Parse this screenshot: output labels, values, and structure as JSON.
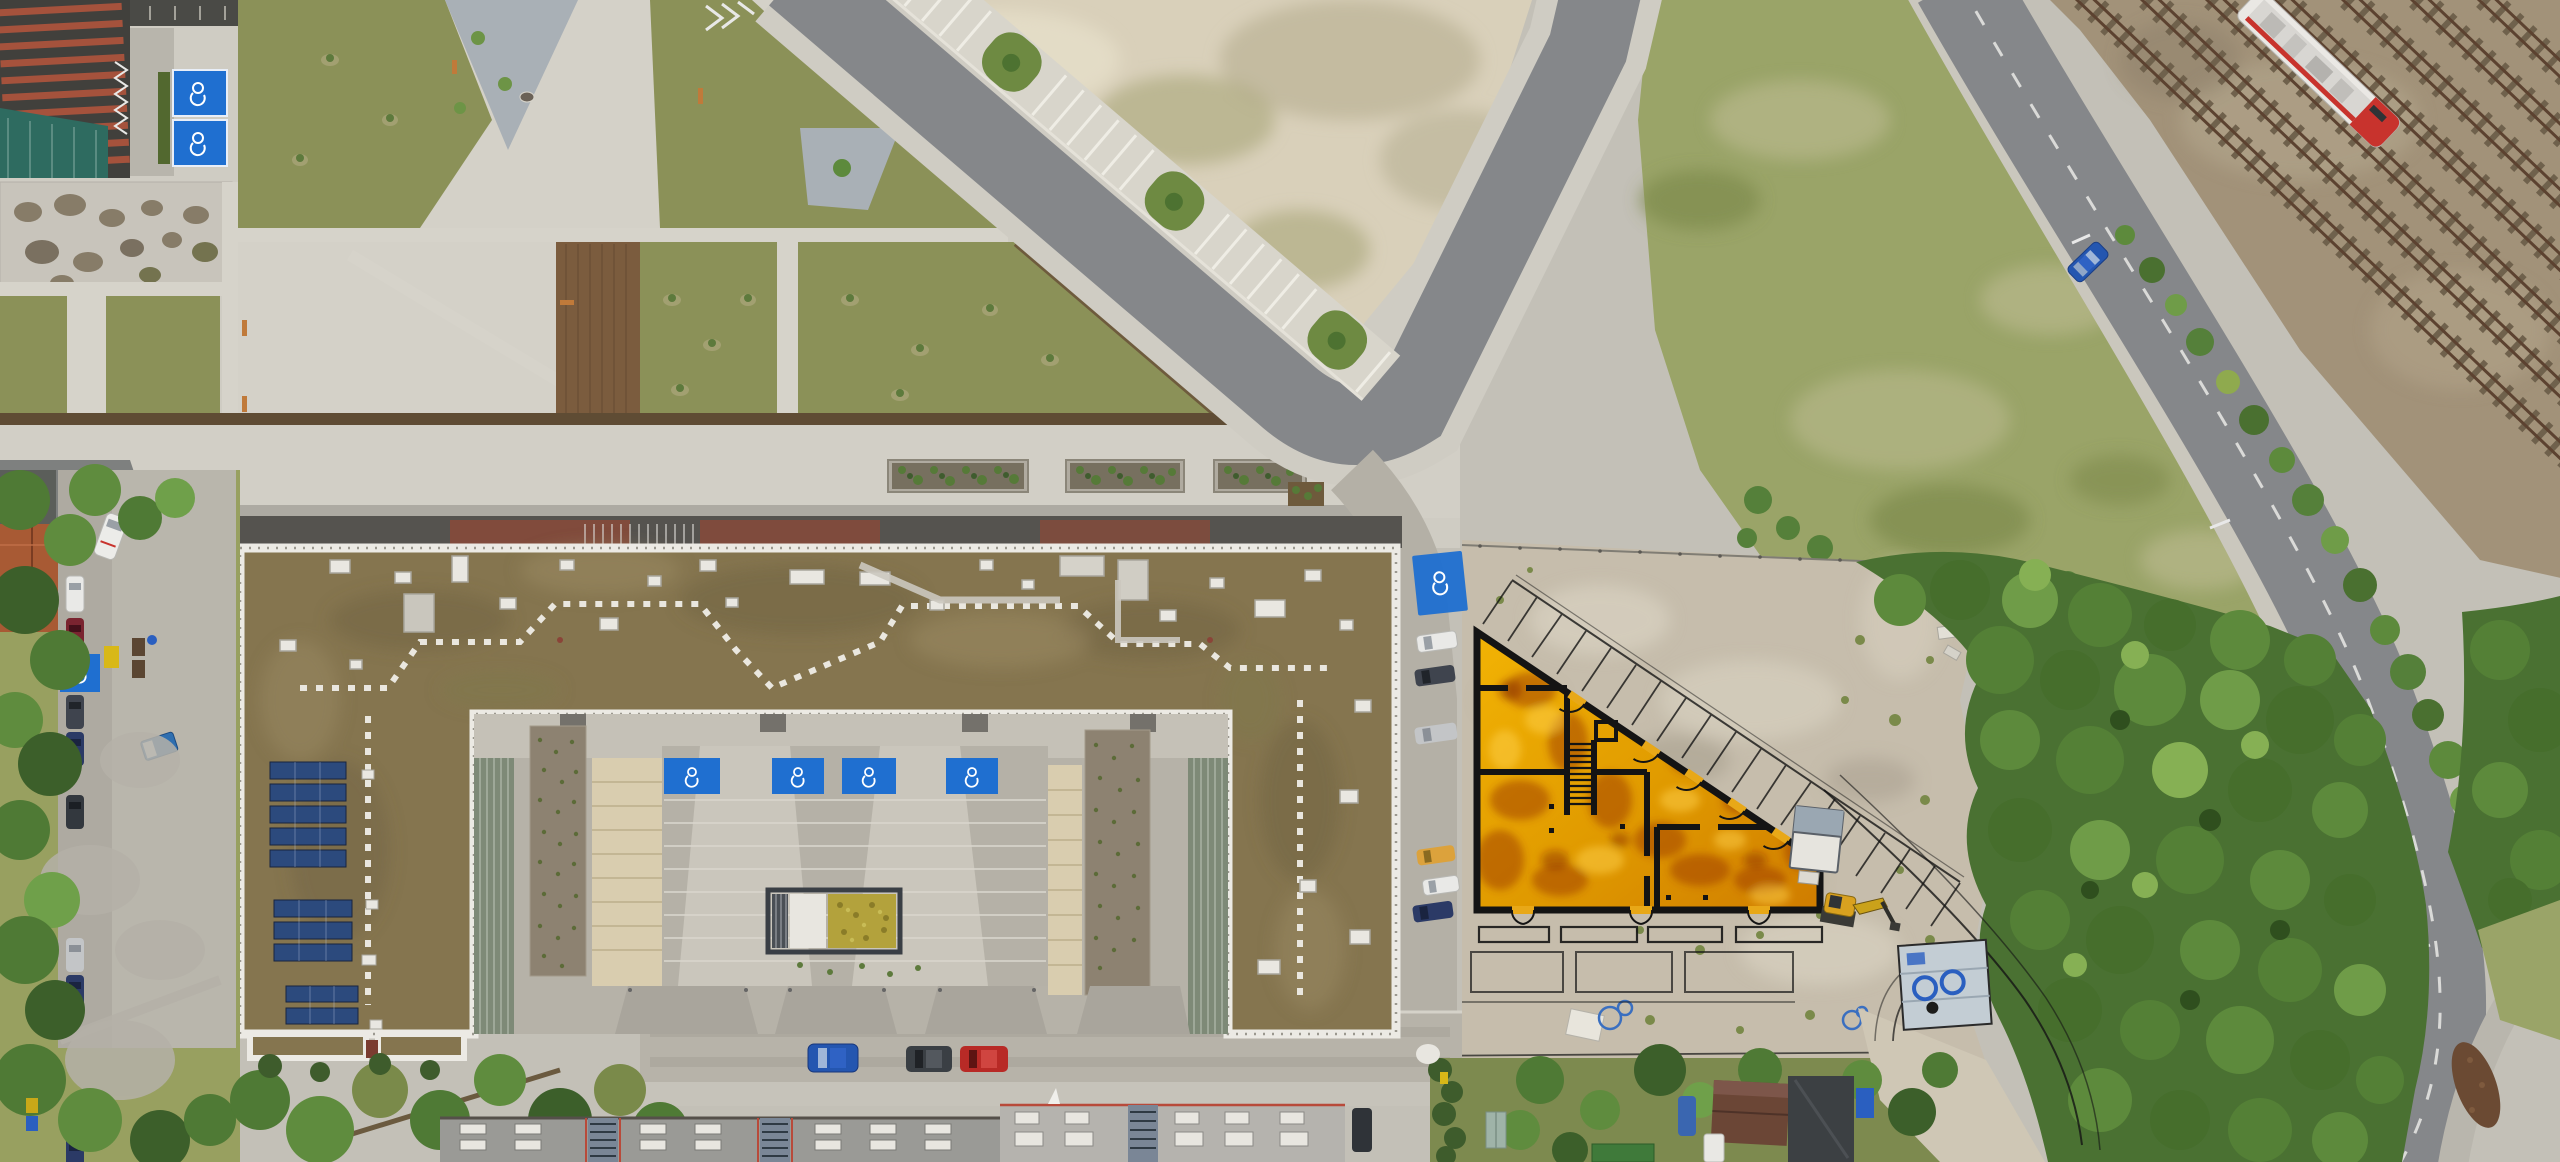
{
  "meta": {
    "description": "Top-down aerial drone photograph of an urban block with a large U-shaped residential building, public plazas, a curving road, railway tracks with a train, forest, and an orange architectural floor-plan overlay on a construction staging site",
    "view": "orthographic top-down",
    "width_px": 2560,
    "height_px": 1162
  },
  "palette": {
    "asphalt": "#85878a",
    "roadlight": "#aeafac",
    "concrete": "#c3c0b7",
    "concretelight": "#d5d2c9",
    "paver": "#b2afa6",
    "gravellot": "#d9d0ba",
    "lawn": "#8b9158",
    "field": "#9aa468",
    "forest": "#4a7132",
    "forestlight": "#6f9c48",
    "forestdark": "#35571f",
    "roofbrown": "#85754f",
    "parapet": "#eceae4",
    "solarblue": "#2c4a7d",
    "bluemarking": "#1f6fd0",
    "tanpath": "#d9cdaf",
    "gravelbed": "#8d8271",
    "ballast": "#a29279",
    "rail": "#5c4230",
    "trainwhite": "#eae8e4",
    "trainred": "#c8332d",
    "overlayorange": "#e39c00",
    "overlaydeep": "#9c3a00",
    "planline": "#141414",
    "excavator": "#d9a11f",
    "housetile": "#a85a34",
    "hedge": "#3e5c2c",
    "carblue": "#2456b0",
    "carred": "#b82a26",
    "caryellow": "#dca23c",
    "carwhite": "#e9e9e7",
    "carsilver": "#c3c5c7",
    "cardark": "#3f444e",
    "binyellow": "#d8b818",
    "tarpblue": "#2a5fc0"
  },
  "scene": {
    "regions": [
      {
        "name": "plaza-park",
        "description": "paved plaza with triangular lawns, gravel gardens, benches and young trees (top left)"
      },
      {
        "name": "gravel-lot",
        "description": "pale empty gravel lot inside road curve (top centre)"
      },
      {
        "name": "main-road",
        "description": "asphalt road with angled parking bays and green islands running diagonally"
      },
      {
        "name": "railway",
        "description": "multiple rail tracks with ballast running diagonally (top right)"
      },
      {
        "name": "residential-building",
        "description": "large U-shaped apartment block, brown flat roof, white parapet, rooftop plant and solar panels"
      },
      {
        "name": "courtyard",
        "description": "south courtyard with accessible parking bays, bike shelter, planted gravel beds"
      },
      {
        "name": "staging-area",
        "description": "concrete construction staging area with debris, shed, excavator"
      },
      {
        "name": "site-plan-overlay",
        "description": "orange architectural ground-floor plan overlay with black walls, stair, door swings, terraces, parking stalls"
      },
      {
        "name": "forest",
        "description": "dense deciduous tree mass (right)"
      },
      {
        "name": "allotment-gardens",
        "description": "small garden plots with sheds and hedges (bottom right)"
      },
      {
        "name": "barracks",
        "description": "long flat-roofed buildings with skylight grids (bottom)"
      }
    ],
    "objects": {
      "train": {
        "count": 1,
        "colors": [
          "white",
          "red"
        ],
        "location": "top right tracks"
      },
      "accessible_parking_bays": {
        "count": 8,
        "color_key": "bluemarking",
        "icon": "wheelchair"
      },
      "solar_panel_rows": 10,
      "promenade_planters": 3,
      "parking_stall_dividers_in_plan": 19,
      "plan_terraces_row1": 4,
      "plan_bottom_door_pairs": 3,
      "excavator": {
        "count": 1,
        "color_key": "excavator"
      },
      "tool_shed": {
        "count": 1
      },
      "equipment_trailer": {
        "count": 1,
        "detail": "pale deck with blue coils"
      },
      "cars": {
        "west_street": [
          "white",
          "darkred",
          "dark",
          "darkblue",
          "dark",
          "silver",
          "darkblue",
          "white",
          "darkblue"
        ],
        "east_street": [
          "white",
          "dark",
          "silver",
          "yellow",
          "white",
          "darkblue"
        ],
        "south_street": [
          "blue",
          "darkgray",
          "red"
        ],
        "moving_on_rail_road": [
          "blue"
        ]
      },
      "bins": [
        "yellow",
        "brown",
        "blue"
      ],
      "portable_toilet": {
        "count": 1,
        "color": "blue-white"
      }
    }
  }
}
